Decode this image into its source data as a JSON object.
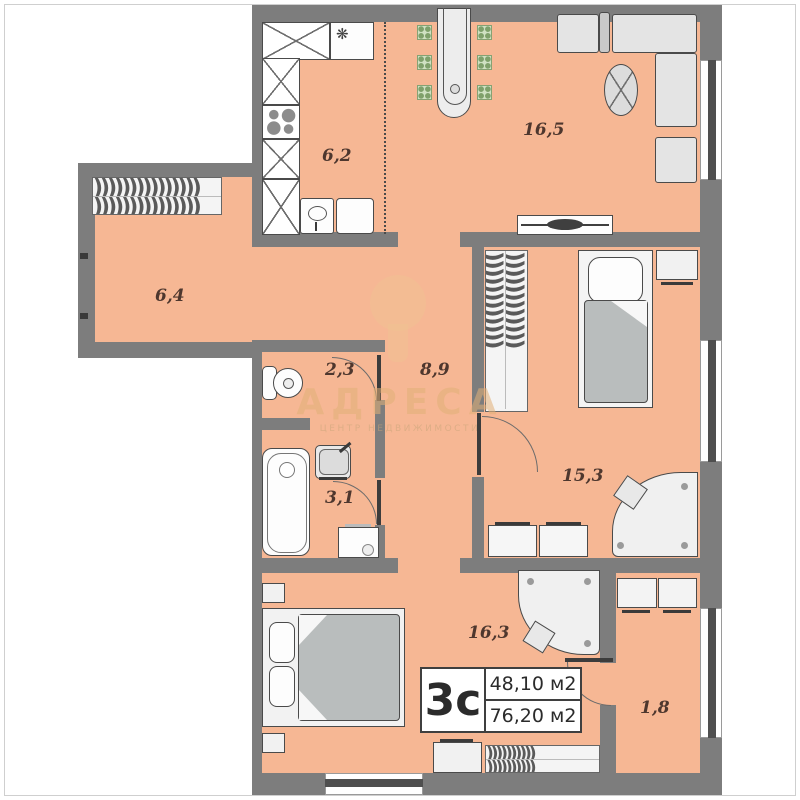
{
  "rooms": [
    {
      "name": "kitchen",
      "area": "6,2"
    },
    {
      "name": "living",
      "area": "16,5"
    },
    {
      "name": "corridor",
      "area": "6,4"
    },
    {
      "name": "toilet",
      "area": "2,3"
    },
    {
      "name": "hall",
      "area": "8,9"
    },
    {
      "name": "bathroom",
      "area": "3,1"
    },
    {
      "name": "bedroom",
      "area": "15,3"
    },
    {
      "name": "bedroom2",
      "area": "16,3"
    },
    {
      "name": "balcony",
      "area": "1,8"
    }
  ],
  "info_box": {
    "flat_type": "3с",
    "area_top": "48,10 м2",
    "area_bottom": "76,20 м2"
  },
  "watermark": {
    "title": "АДРЕСА",
    "tagline": "ЦЕНТР НЕДВИЖИМОСТИ"
  },
  "icons": {
    "snowflake": "❋"
  },
  "patterns": {
    "hanger_row_long": ")))))))))))))))",
    "hanger_row_mid": "))))))))))",
    "hanger_row_vert": "))))))))))))"
  },
  "colors": {
    "floor": "#f6b794",
    "wall": "#7d7d7d",
    "glass": "#4f4f4f",
    "outline": "#4a4a4a",
    "blanket": "#b9bdbd",
    "chair": "#cfe0c2",
    "label": "#4e372e",
    "watermark": "#e2b078"
  }
}
